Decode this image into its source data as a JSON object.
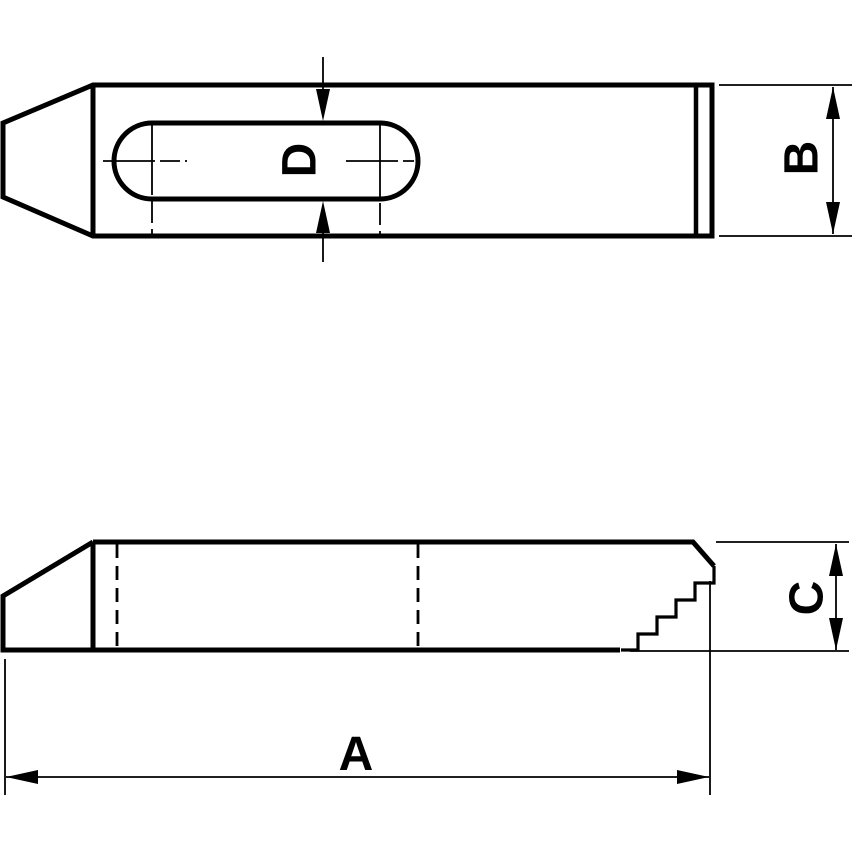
{
  "drawing": {
    "colors": {
      "line": "#000000",
      "background": "#ffffff"
    },
    "dimension_labels": {
      "length": "A",
      "width": "B",
      "thickness": "C",
      "slot_width": "D"
    }
  }
}
